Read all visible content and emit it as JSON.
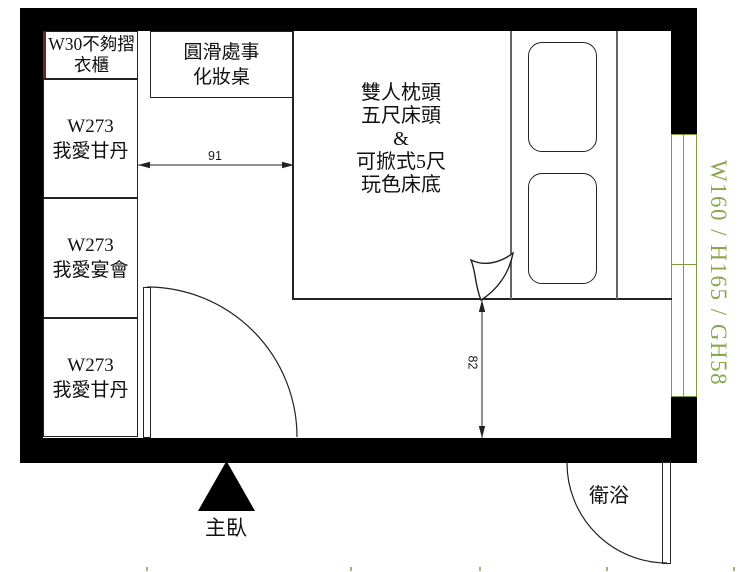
{
  "plan": {
    "room_label": "主臥",
    "bathroom_label": "衛浴",
    "window_note": "W160 / H165 / GH58",
    "wardrobe_sections": [
      {
        "line1": "W30不夠摺",
        "line2": "衣櫃"
      },
      {
        "line1": "W273",
        "line2": "我愛甘丹"
      },
      {
        "line1": "W273",
        "line2": "我愛宴會"
      },
      {
        "line1": "W273",
        "line2": "我愛甘丹"
      }
    ],
    "dressing_table": {
      "line1": "圓滑處事",
      "line2": "化妝桌"
    },
    "bed": {
      "line1": "雙人枕頭",
      "line2": "五尺床頭",
      "line3": "&",
      "line4": "可掀式5尺",
      "line5": "玩色床底"
    },
    "dimensions": {
      "opening_width": "91",
      "bed_to_wall": "82"
    },
    "colors": {
      "wall": "#000000",
      "outline": "#222222",
      "light_divider": "#666666",
      "window_green": "#7c9b3e",
      "note_green": "#87a84e",
      "closet_accent_red": "#7a2026"
    }
  }
}
